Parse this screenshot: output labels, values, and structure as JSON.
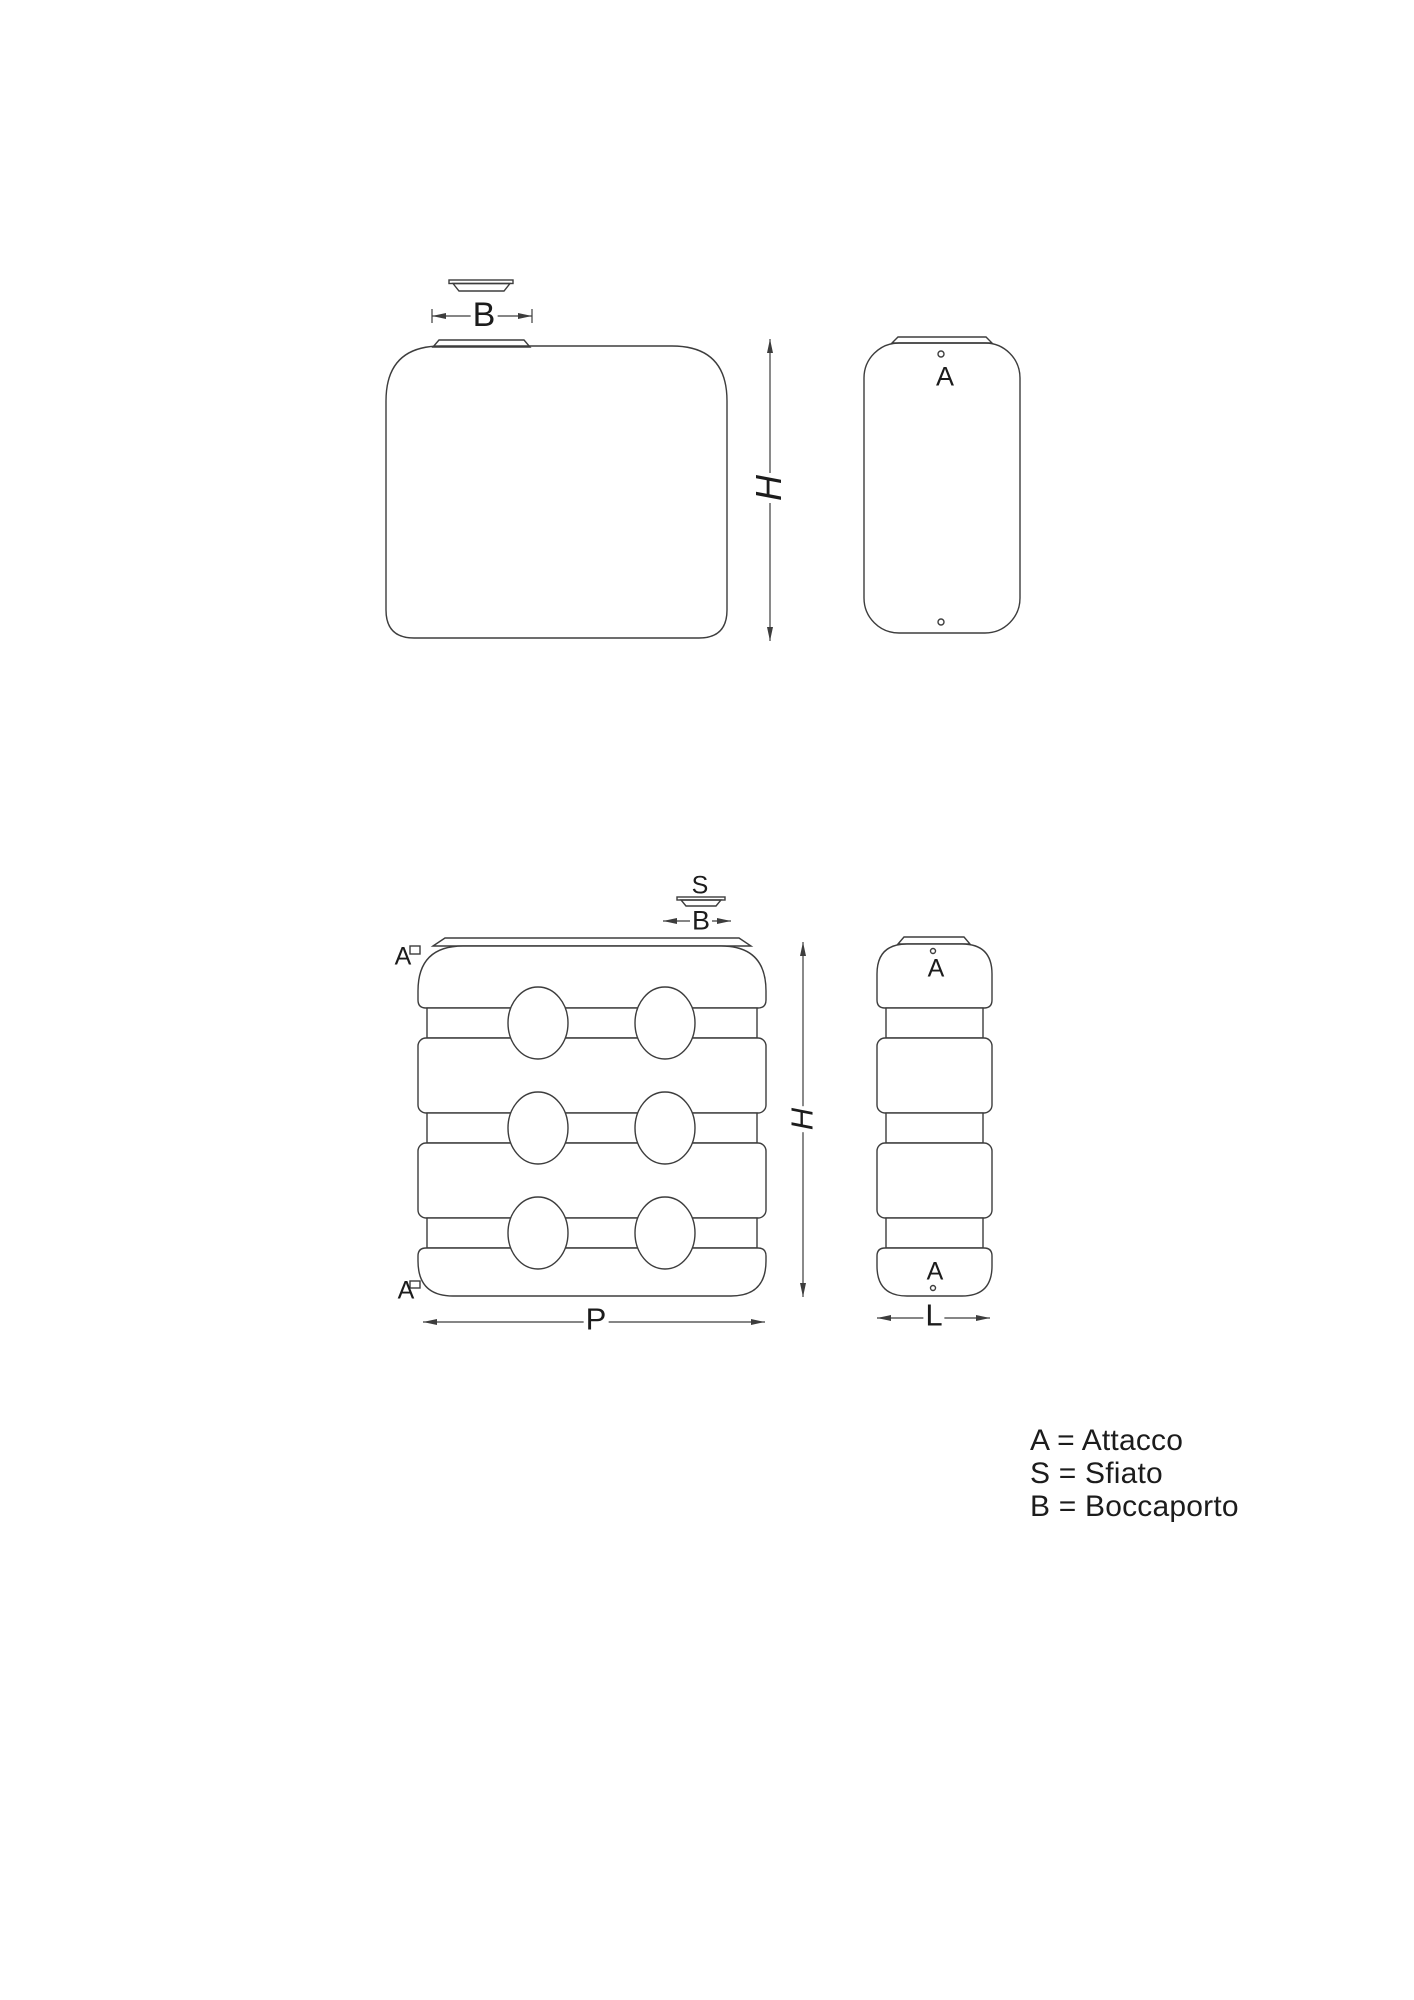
{
  "page": {
    "title": "Serbatoio acqua - disegno tecnico",
    "colors": {
      "background": "#ffffff",
      "line": "#3d3d3d",
      "text": "#1c1c1c"
    }
  },
  "drawing_top": {
    "front_view": {
      "dim_b": "B",
      "dim_h": "H"
    },
    "side_view": {
      "label_a": "A"
    }
  },
  "drawing_bottom": {
    "front_view": {
      "label_s": "S",
      "dim_b": "B",
      "label_a_top": "A",
      "label_a_bottom": "A",
      "dim_h": "H",
      "dim_p": "P"
    },
    "side_view": {
      "label_a_top": "A",
      "label_a_bottom": "A",
      "dim_l": "L"
    }
  },
  "legend": {
    "items": [
      {
        "text": "A = Attacco"
      },
      {
        "text": "S = Sfiato"
      },
      {
        "text": "B = Boccaporto"
      }
    ]
  }
}
